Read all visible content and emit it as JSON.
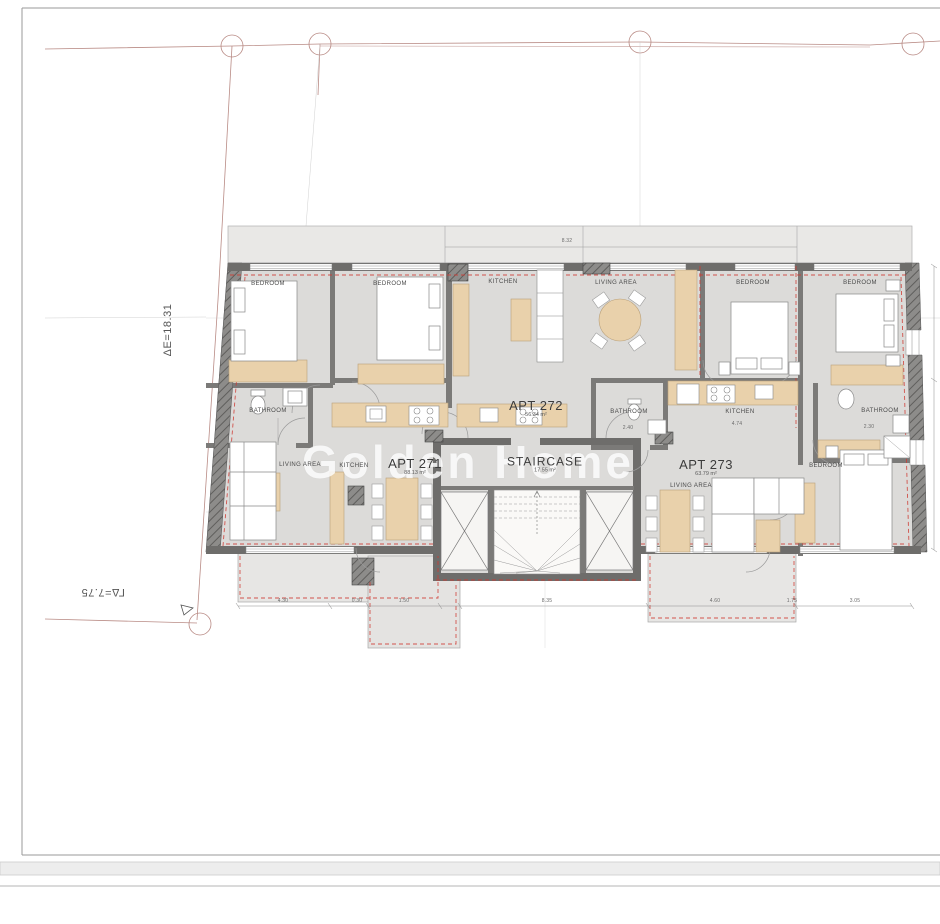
{
  "watermark": "Golden Home",
  "site_annotations": {
    "elevation_left": "ΔE=18.31",
    "elevation_bottom": "ΓΔ=7.75"
  },
  "apartments": [
    {
      "name": "APT 271",
      "area": "88.13 m²"
    },
    {
      "name": "APT 272",
      "area": "56.34 m²"
    },
    {
      "name": "APT 273",
      "area": "63.79 m²"
    }
  ],
  "staircase": {
    "name": "STAIRCASE",
    "area": "17.55 m²"
  },
  "rooms": [
    {
      "label": "BEDROOM"
    },
    {
      "label": "BEDROOM"
    },
    {
      "label": "KITCHEN"
    },
    {
      "label": "LIVING AREA"
    },
    {
      "label": "BEDROOM"
    },
    {
      "label": "BEDROOM"
    },
    {
      "label": "BATHROOM"
    },
    {
      "label": "BATHROOM"
    },
    {
      "label": "KITCHEN"
    },
    {
      "label": "BATHROOM"
    },
    {
      "label": "LIVING AREA"
    },
    {
      "label": "KITCHEN"
    },
    {
      "label": "LIVING AREA"
    },
    {
      "label": "BEDROOM"
    }
  ],
  "dimensions": [
    {
      "value": "8.32"
    },
    {
      "value": "4.30"
    },
    {
      "value": "0.30"
    },
    {
      "value": "1.50"
    },
    {
      "value": "8.35"
    },
    {
      "value": "4.60"
    },
    {
      "value": "1.75"
    },
    {
      "value": "3.05"
    },
    {
      "value": "4.74"
    },
    {
      "value": "2.40"
    },
    {
      "value": "2.30"
    }
  ],
  "colors": {
    "floor": "#dcdbd9",
    "wall_dark": "#6e6d6b",
    "furniture_tan": "#e9d1ab",
    "red_dashed": "#cf3a32",
    "boundary": "#b98b85"
  }
}
